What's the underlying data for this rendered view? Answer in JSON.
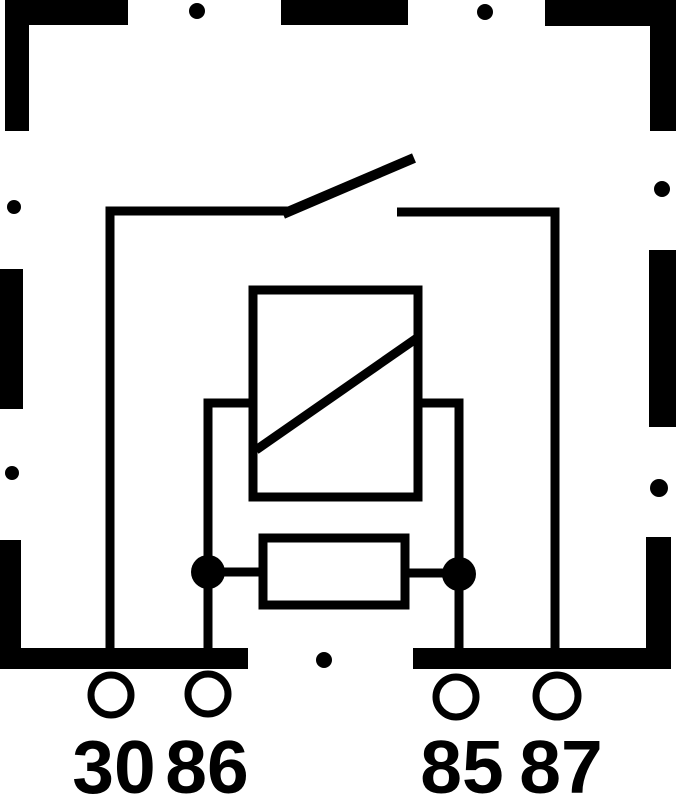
{
  "diagram": {
    "kind": "relay-circuit-schematic",
    "terminal_labels": {
      "t30": "30",
      "t86": "86",
      "t85": "85",
      "t87": "87"
    },
    "components": [
      "dashed-housing-outline",
      "normally-open-switch-contact",
      "relay-coil-with-diagonal",
      "yoke-frame",
      "resistor",
      "junction-dots",
      "terminal-pins"
    ],
    "colors": {
      "line": "#000000",
      "background": "#ffffff"
    }
  }
}
